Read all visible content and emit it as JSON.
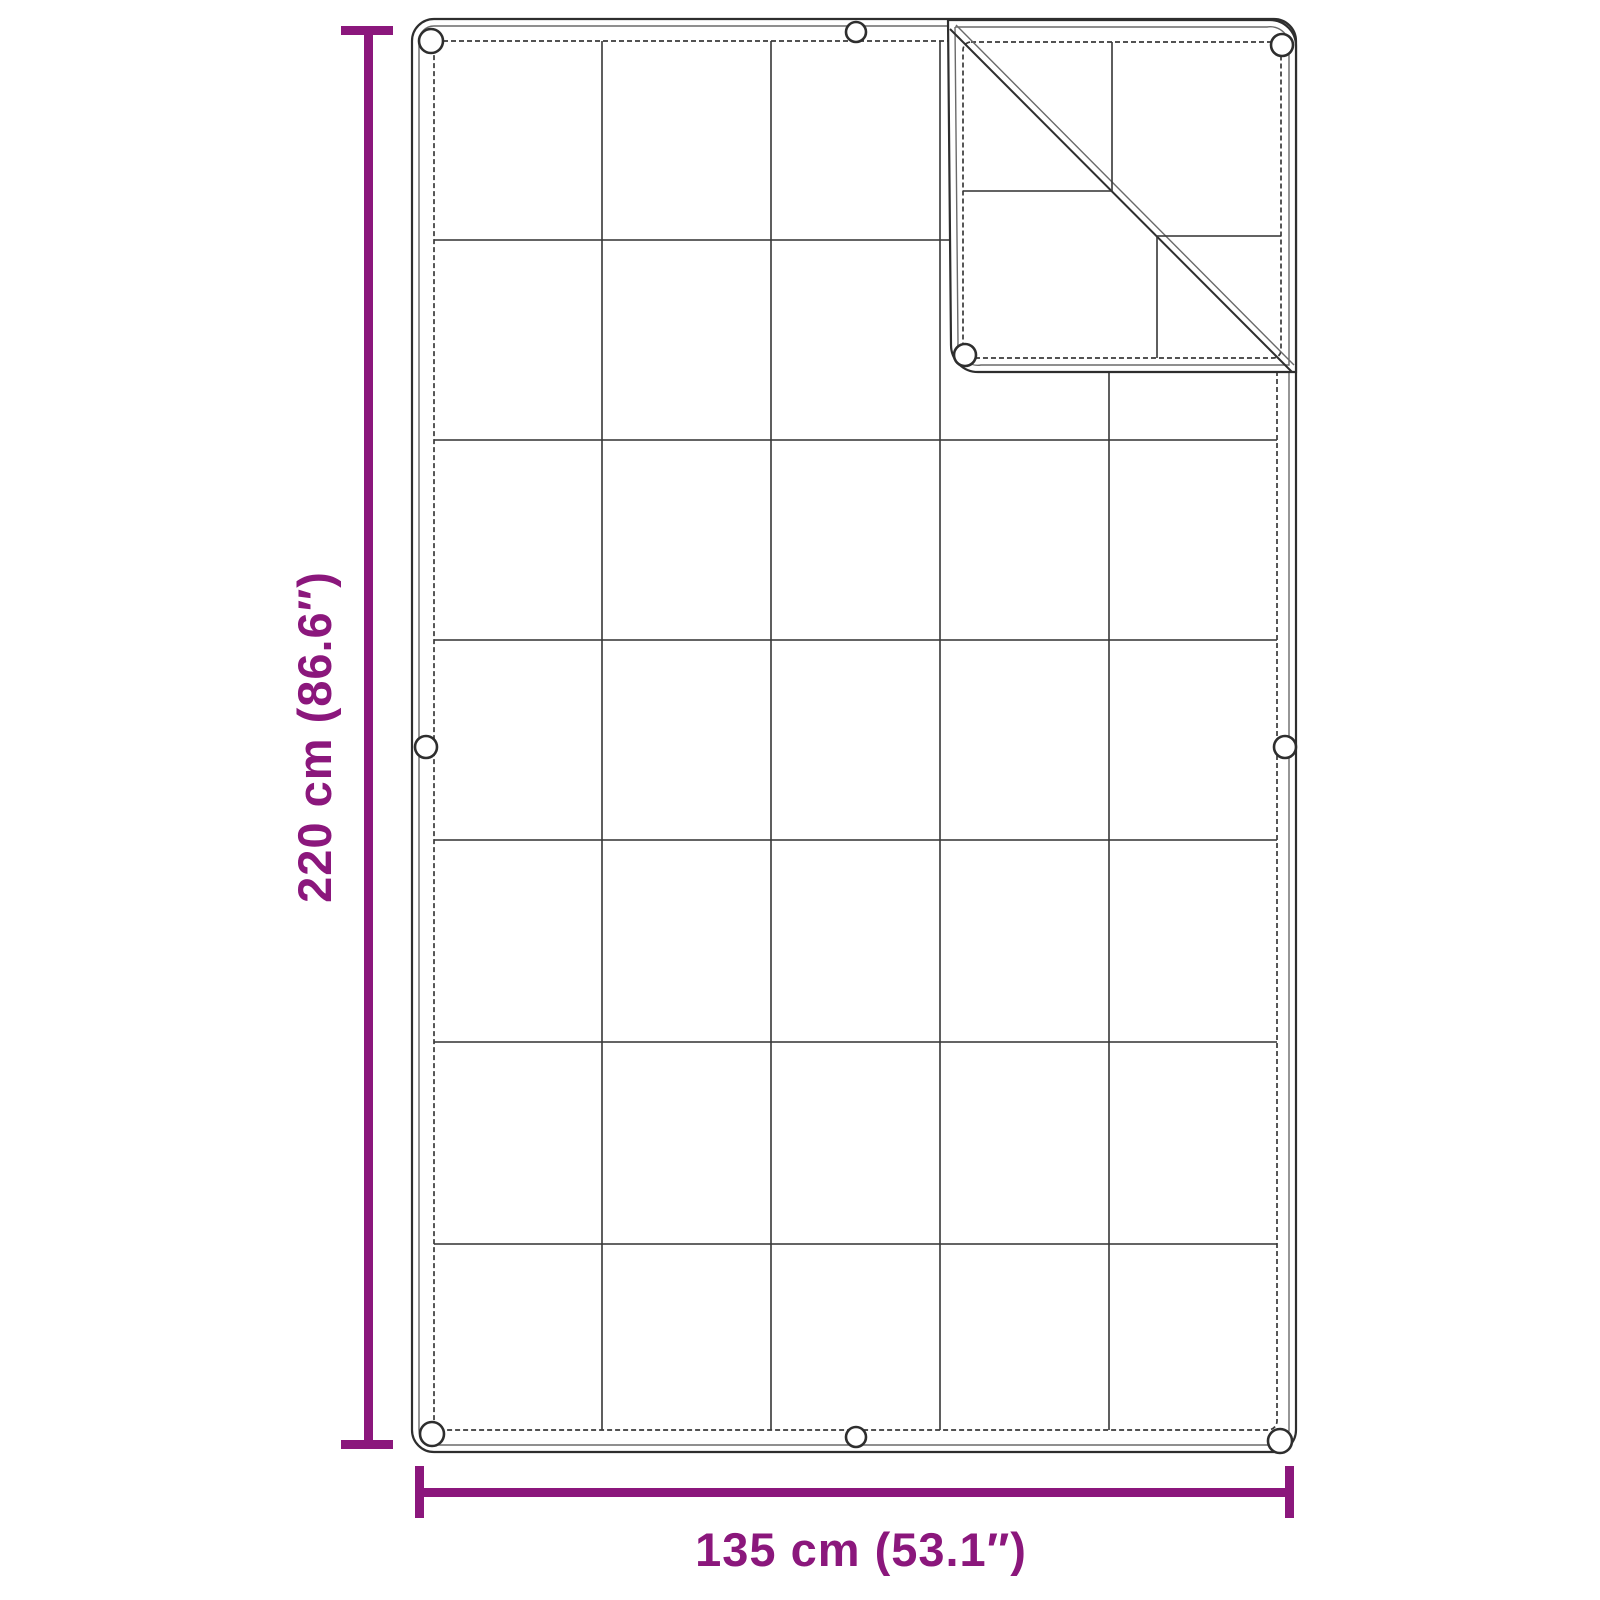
{
  "diagram": {
    "kind": "product-dimension-diagram",
    "subject": "tarp-with-grid-seams-and-folded-corner",
    "dimensions": {
      "height_label": "220 cm (86.6″)",
      "width_label": "135 cm (53.1″)",
      "height_value_cm": 220,
      "height_value_inch": 86.6,
      "width_value_cm": 135,
      "width_value_inch": 53.1
    },
    "colors": {
      "accent": "#8B177C",
      "line": "#3a3a3a",
      "background": "#ffffff"
    },
    "grid": {
      "columns": 5,
      "rows": 7
    },
    "grommets": {
      "visible_count": 9
    },
    "folded_corner": {
      "position": "top-right",
      "crease": "diagonal"
    }
  }
}
